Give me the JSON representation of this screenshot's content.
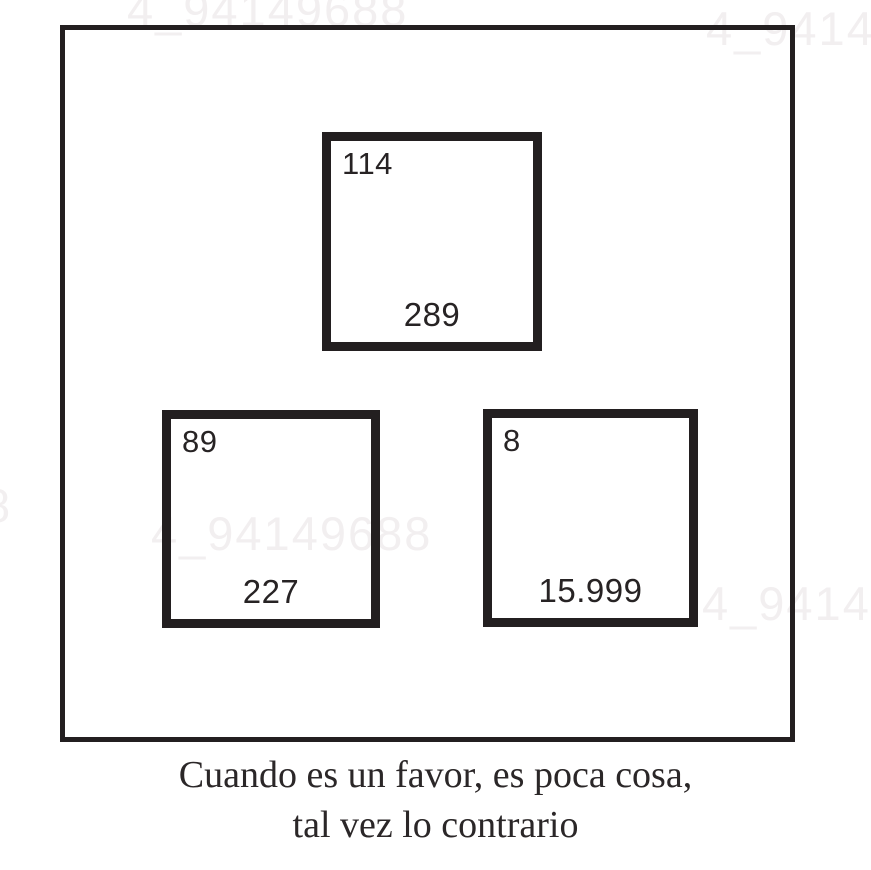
{
  "squares": {
    "top": {
      "corner": "114",
      "bottom": "289"
    },
    "bottom_left": {
      "corner": "89",
      "bottom": "227"
    },
    "bottom_right": {
      "corner": "8",
      "bottom": "15.999"
    }
  },
  "caption": {
    "line1": "Cuando es un favor, es poca cosa,",
    "line2": "tal vez lo contrario"
  },
  "watermark": {
    "text": "4_94149688",
    "partial_text": "8"
  },
  "colors": {
    "background": "#ffffff",
    "line": "#231f20",
    "number_text": "#272324",
    "caption_text": "#2b2728",
    "watermark": "#f2eff0"
  }
}
